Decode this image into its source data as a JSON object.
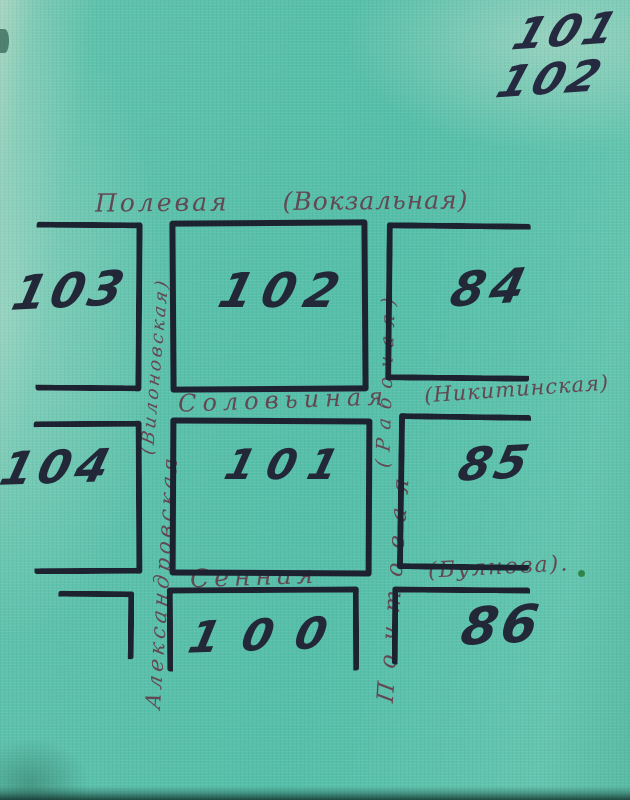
{
  "page_corner": {
    "line1": "101",
    "line2": "102"
  },
  "streets": {
    "polevaya": {
      "name": "Полевая",
      "former": "(Вокзальная)"
    },
    "solovyinaya": {
      "name": "Соловьиная",
      "former": "(Никитинская)"
    },
    "sennaya": {
      "name": "Сенная",
      "former": "(Буянова)."
    },
    "aleksandrovskaya": {
      "name": "Александровская",
      "former": "(Вилоновская)"
    },
    "pochtovaya": {
      "name": "Почтовая",
      "former": "(Рабочая)"
    }
  },
  "blocks": {
    "b103": "103",
    "b102": "102",
    "b84": "84",
    "b104": "104",
    "b101": "101",
    "b85": "85",
    "b100": "100",
    "b86": "86"
  },
  "colors": {
    "paper": "#59c0aa",
    "ink": "#1d2231",
    "label_ink": "#634752",
    "dot_green": "#2f8547"
  }
}
